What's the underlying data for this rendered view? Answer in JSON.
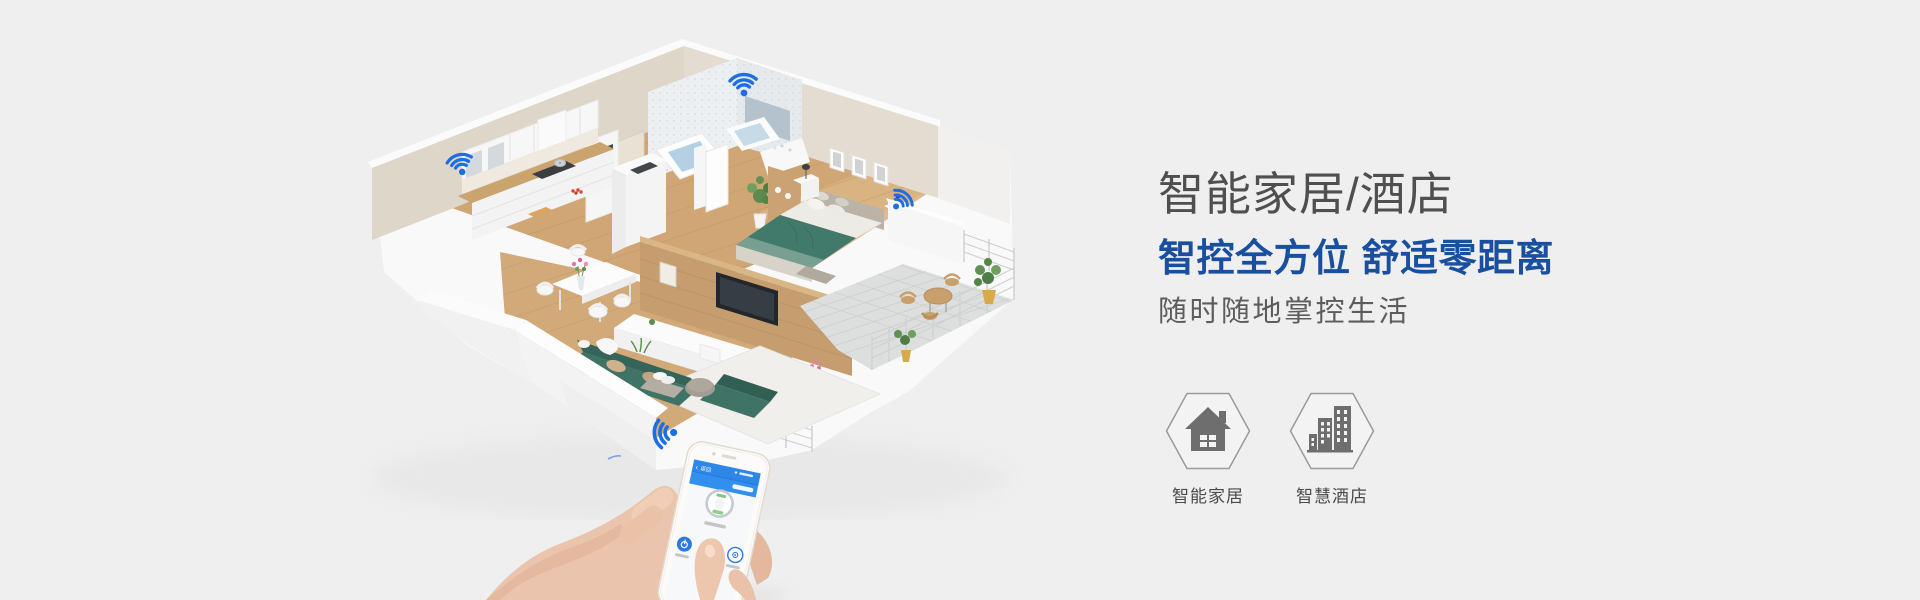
{
  "page": {
    "background": "#efefef"
  },
  "hero": {
    "title": "智能家居/酒店",
    "subtitle": "智控全方位 舒适零距离",
    "tagline": "随时随地掌控生活"
  },
  "features": [
    {
      "label": "智能家居",
      "icon": "home-icon"
    },
    {
      "label": "智慧酒店",
      "icon": "hotel-icon"
    }
  ],
  "phone": {
    "back_chevron": "‹",
    "back_label": "返回"
  },
  "icons": {
    "wifi": "wifi-icon",
    "home": "home-icon",
    "hotel": "hotel-icon"
  },
  "colors": {
    "wifi_blue": "#1d6ee2",
    "headline_gray": "#4f4f4f",
    "accent_blue": "#1a4fa0",
    "phone_header_blue": "#2d86e8",
    "icon_gray": "#6e6e6e",
    "sofa_teal": "#3f7366",
    "wood_floor": "#cfa674"
  }
}
